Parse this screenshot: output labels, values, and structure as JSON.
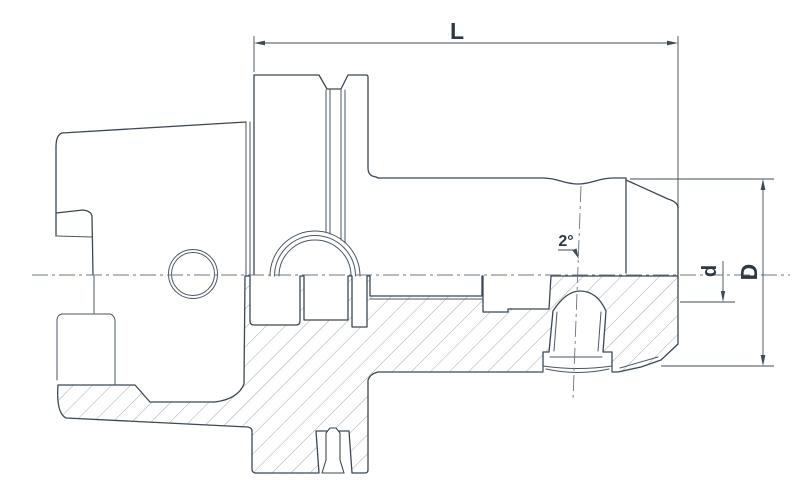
{
  "drawing": {
    "type": "engineering-half-section",
    "subject": "HSK tool holder chuck",
    "dimensions": {
      "length_label": "L",
      "taper_angle_label": "2°",
      "bore_diameter_label": "d",
      "outer_diameter_label": "D"
    },
    "colors": {
      "line": "#3b4754",
      "hatch": "#98a2ae",
      "dimension": "#3f4b58",
      "centerline": "#6a7583",
      "background": "#ffffff",
      "text": "#2c3845"
    }
  }
}
